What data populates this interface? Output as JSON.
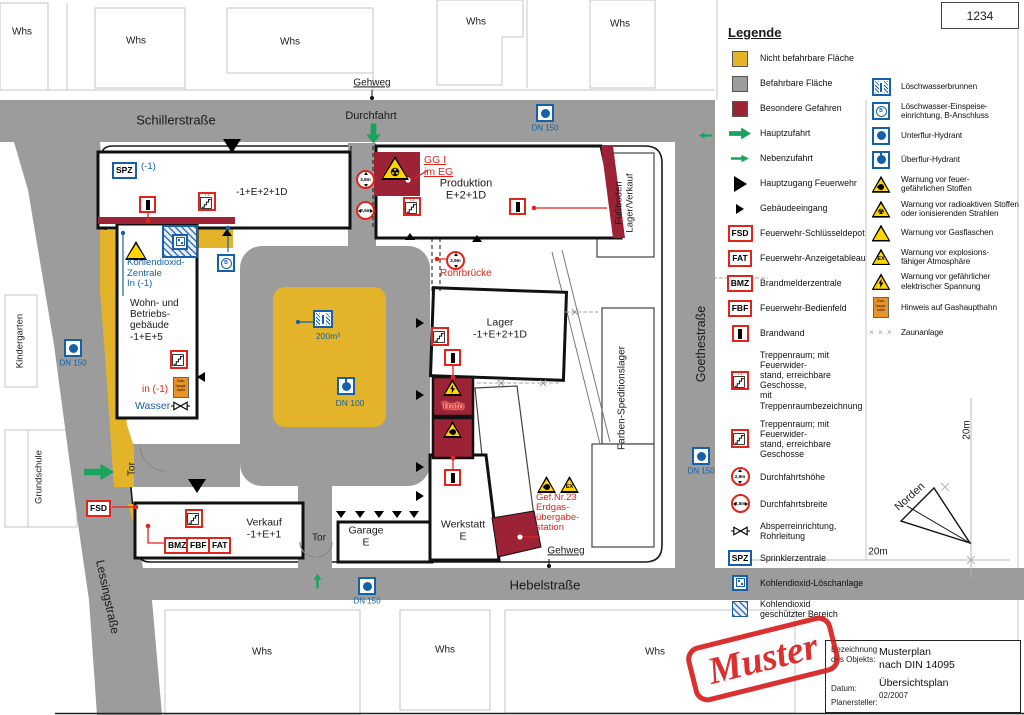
{
  "plan_number": "1234",
  "colors": {
    "non_drivable": "#E3B329",
    "drivable": "#9C9C9C",
    "special_hazard": "#9B2335",
    "symbol_red": "#E3231C",
    "symbol_blue": "#1560A8",
    "access_green": "#18A45C",
    "warning_yellow": "#FFD500",
    "gas_orange": "#E8922A"
  },
  "icons": {
    "fsd": "FSD",
    "fat": "FAT",
    "bmz": "BMZ",
    "fbf": "FBF",
    "spz": "SPZ",
    "b": "B",
    "ex": "EX",
    "radioactive": "☢",
    "gas_tap": "Gas-\nhaupt-\nhahn",
    "fence_marks": "× × ×"
  },
  "streets": {
    "schiller": "Schillerstraße",
    "lessing": "Lessingstraße",
    "goethe": "Goethestraße",
    "hebel": "Hebelstraße"
  },
  "surroundings": {
    "warehouse": "Whs",
    "kindergarten": "Kindergarten",
    "grundschule": "Grundschule"
  },
  "site": {
    "gehweg": "Gehweg",
    "durchfahrt": "Durchfahrt",
    "tor": "Tor",
    "dn150": "DN 150",
    "dn100": "DN 100",
    "tank_volume": "200m³",
    "spz_level": "(-1)",
    "strip_levels": "-1+E+2+1D",
    "produktion": "Produktion\nE+2+1D",
    "gg": "GG I\nim EG",
    "height_38": "3,8m",
    "width_35": "3,5m",
    "height_29": "2,9m",
    "rohrbruecke": "Rohrbrücke",
    "t1": "T1",
    "t2": "T2",
    "co2_zentrale": "Kohlendioxid-\nZentrale\nIn (-1)",
    "wohngebaeude": "Wohn- und\nBetriebs-\ngebäude\n-1+E+5",
    "in_basement": "in (-1)",
    "wasser": "Wasser",
    "lager": "Lager\n-1+E+2+1D",
    "trafo": "Trafo",
    "fussboden": "Fußboden\nLager/Verkauf",
    "farben": "Farben-Speditionslager",
    "gefahr": "Gef.Nr.23\nErdgas-\nübergabe-\nstation",
    "werkstatt": "Werkstatt\nE",
    "garage": "Garage\nE",
    "verkauf": "Verkauf\n-1+E+1",
    "norden": "Norden",
    "scale_20m": "20m"
  },
  "legend": {
    "title": "Legende",
    "left": [
      {
        "label": "Nicht befahrbare Fläche"
      },
      {
        "label": "Befahrbare Fläche"
      },
      {
        "label": "Besondere Gefahren"
      },
      {
        "label": "Hauptzufahrt"
      },
      {
        "label": "Nebenzufahrt"
      },
      {
        "label": "Hauptzugang Feuerwehr"
      },
      {
        "label": "Gebäudeeingang"
      },
      {
        "label": "Feuerwehr-Schlüsseldepot"
      },
      {
        "label": "Feuerwehr-Anzeigetableau"
      },
      {
        "label": "Brandmelderzentrale"
      },
      {
        "label": "Feuerwehr-Bedienfeld"
      },
      {
        "label": "Brandwand"
      },
      {
        "label": "Treppenraum; mit Feuerwider-\nstand, erreichbare Geschosse,\nmit Treppenraumbezeichnung"
      },
      {
        "label": "Treppenraum; mit Feuerwider-\nstand, erreichbare Geschosse"
      },
      {
        "label": "Durchfahrtshöhe",
        "value": "2,9m"
      },
      {
        "label": "Durchfahrtsbreite",
        "value": "3,5m"
      },
      {
        "label": "Absperreinrichtung,\nRohrleitung"
      },
      {
        "label": "Sprinklerzentrale"
      },
      {
        "label": "Kohlendioxid-Löschanlage"
      },
      {
        "label": "Kohlendioxid\ngeschützter Bereich"
      }
    ],
    "right": [
      {
        "label": "Löschwasserbrunnen"
      },
      {
        "label": "Löschwasser-Einspeise-\neinrichtung, B-Anschluss"
      },
      {
        "label": "Unterflur-Hydrant"
      },
      {
        "label": "Überflur-Hydrant"
      },
      {
        "label": "Warnung vor feuer-\ngefährlichen Stoffen"
      },
      {
        "label": "Warnung vor radioaktiven Stoffen\noder ionisierenden Strahlen"
      },
      {
        "label": "Warnung vor Gasflaschen"
      },
      {
        "label": "Warnung vor explosions-\nfähiger Atmosphäre"
      },
      {
        "label": "Warnung vor gefährlicher\nelektrischer Spannung"
      },
      {
        "label": "Hinweis auf Gashaupthahn"
      },
      {
        "label": "Zaunanlage"
      }
    ]
  },
  "title_block": {
    "label_object": "Bezeichnung\ndes Objekts:",
    "object_name": "Musterplan\nnach DIN 14095",
    "plan_type": "Übersichtsplan",
    "label_date": "Datum:",
    "date": "02/2007",
    "label_planner": "Planersteller:"
  },
  "stamp": {
    "text": "Muster"
  }
}
